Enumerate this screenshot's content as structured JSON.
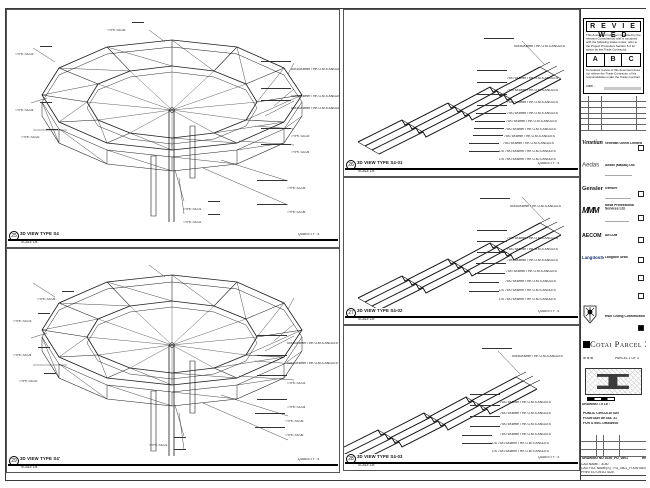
{
  "panels": [
    {
      "view_no": "25",
      "title": "3D VIEW TYPE S4",
      "scale": "SCALE 1/8",
      "quantity": "QUANTITY : 4",
      "callouts": [
        {
          "t": "TYPE S4-03",
          "x": 8,
          "y": 34,
          "a": "l"
        },
        {
          "t": "TYPE S4-05",
          "x": 100,
          "y": 10,
          "a": "l"
        },
        {
          "t": "TYPE S4-04",
          "x": 8,
          "y": 90,
          "a": "l"
        },
        {
          "t": "TYPE S4-02",
          "x": 14,
          "y": 117,
          "a": "l"
        },
        {
          "t": "50X50X6mm THK G.M.S ANGLES",
          "x": 284,
          "y": 49,
          "a": "r"
        },
        {
          "t": "50X50X6mm THK G.M.S ANGLES",
          "x": 284,
          "y": 76,
          "a": "r"
        },
        {
          "t": "50X50X6mm THK G.M.S ANGLES",
          "x": 284,
          "y": 88,
          "a": "r"
        },
        {
          "t": "TYPE S4-03",
          "x": 284,
          "y": 116,
          "a": "r"
        },
        {
          "t": "TYPE S4-04",
          "x": 284,
          "y": 132,
          "a": "r"
        },
        {
          "t": "TYPE S4-05",
          "x": 280,
          "y": 168,
          "a": "r"
        },
        {
          "t": "TYPE S4-06",
          "x": 280,
          "y": 192,
          "a": "r"
        },
        {
          "t": "TYPE S4-01",
          "x": 176,
          "y": 189,
          "a": "l"
        },
        {
          "t": "TYPE S4-02",
          "x": 176,
          "y": 202,
          "a": "l"
        }
      ]
    },
    {
      "view_no": "29",
      "title": "3D VIEW TYPE S4'",
      "scale": "SCALE 1/8",
      "quantity": "QUANTITY : 4",
      "callouts": [
        {
          "t": "TYPE S4-05",
          "x": 30,
          "y": 40,
          "a": "l"
        },
        {
          "t": "TYPE S4-03",
          "x": 6,
          "y": 62,
          "a": "l"
        },
        {
          "t": "TYPE S4-04",
          "x": 6,
          "y": 96,
          "a": "l"
        },
        {
          "t": "TYPE S4-02",
          "x": 12,
          "y": 122,
          "a": "l"
        },
        {
          "t": "50X50X6mm THK G.M.S ANGLES",
          "x": 280,
          "y": 84,
          "a": "r"
        },
        {
          "t": "50X50X6mm THK G.M.S ANGLES",
          "x": 280,
          "y": 104,
          "a": "r"
        },
        {
          "t": "TYPE S4-03",
          "x": 280,
          "y": 124,
          "a": "r"
        },
        {
          "t": "TYPE S4-04",
          "x": 280,
          "y": 148,
          "a": "r"
        },
        {
          "t": "TYPE S4-05",
          "x": 278,
          "y": 162,
          "a": "r"
        },
        {
          "t": "TYPE S4-06",
          "x": 278,
          "y": 176,
          "a": "r"
        },
        {
          "t": "TYPE S4-01",
          "x": 142,
          "y": 186,
          "a": "l"
        },
        {
          "t": "TYPE S4-02",
          "x": 142,
          "y": 198,
          "a": "l"
        }
      ]
    },
    {
      "view_no": "26",
      "title": "3D VIEW TYPE S4-01",
      "scale": "SCALE 1/8",
      "quantity": "QUANTITY : 4",
      "callouts": [
        {
          "t": "50X50X6mm THK G.M.S ANGLES",
          "x": 170,
          "y": 26,
          "a": "r"
        },
        {
          "t": "75X75X6mm THK G.M.S ANGLES",
          "x": 163,
          "y": 58,
          "a": "r"
        },
        {
          "t": "75X75X6mm THK G.M.S ANGLES",
          "x": 163,
          "y": 70,
          "a": "r"
        },
        {
          "t": "75X75X6mm THK G.M.S ANGLES",
          "x": 163,
          "y": 82,
          "a": "r"
        },
        {
          "t": "75X75X6mm THK G.M.S ANGLES",
          "x": 163,
          "y": 93,
          "a": "r"
        },
        {
          "t": "75X75X6mm THK G.M.S ANGLES",
          "x": 162,
          "y": 101,
          "a": "r"
        },
        {
          "t": "75X75X6mm THK G.M.S ANGLES",
          "x": 161,
          "y": 109,
          "a": "r"
        },
        {
          "t": "75X75X6mm THK G.M.S ANGLES",
          "x": 160,
          "y": 116,
          "a": "r"
        },
        {
          "t": "75X75X6mm THK G.M.S ANGLES",
          "x": 159,
          "y": 123,
          "a": "r"
        },
        {
          "t": "L/S 75X75X6mm THK G.M.S ANGLES",
          "x": 155,
          "y": 131,
          "a": "r"
        },
        {
          "t": "L/S 75X75X6mm THK G.M.S ANGLES",
          "x": 155,
          "y": 139,
          "a": "r"
        }
      ]
    },
    {
      "view_no": "27",
      "title": "3D VIEW TYPE S4-02",
      "scale": "SCALE 1/8",
      "quantity": "QUANTITY : 4",
      "callouts": [
        {
          "t": "50X50X6mm THK G.M.S ANGLES",
          "x": 166,
          "y": 18,
          "a": "r"
        },
        {
          "t": "75X75X6mm THK G.M.S ANGLES",
          "x": 163,
          "y": 50,
          "a": "r"
        },
        {
          "t": "75X75X6mm THK G.M.S ANGLES",
          "x": 163,
          "y": 61,
          "a": "r"
        },
        {
          "t": "75X75X6mm THK G.M.S ANGLES",
          "x": 163,
          "y": 72,
          "a": "r"
        },
        {
          "t": "75X75X6mm THK G.M.S ANGLES",
          "x": 162,
          "y": 83,
          "a": "r"
        },
        {
          "t": "75X75X6mm THK G.M.S ANGLES",
          "x": 161,
          "y": 93,
          "a": "r"
        },
        {
          "t": "L/S 75X75X6mm THK G.M.S ANGLES",
          "x": 155,
          "y": 102,
          "a": "r"
        },
        {
          "t": "L/S 75X75X6mm THK G.M.S ANGLES",
          "x": 155,
          "y": 111,
          "a": "r"
        }
      ]
    },
    {
      "view_no": "28",
      "title": "3D VIEW TYPE S4-03",
      "scale": "SCALE 1/8",
      "quantity": "QUANTITY : 4",
      "callouts": [
        {
          "t": "50X50X6mm THK G.M.S ANGLES",
          "x": 168,
          "y": 20,
          "a": "r"
        },
        {
          "t": "75X75X6mm THK G.M.S ANGLES",
          "x": 156,
          "y": 66,
          "a": "r"
        },
        {
          "t": "75X75X6mm THK G.M.S ANGLES",
          "x": 156,
          "y": 77,
          "a": "r"
        },
        {
          "t": "75X75X6mm THK G.M.S ANGLES",
          "x": 156,
          "y": 88,
          "a": "r"
        },
        {
          "t": "75X75X6mm THK G.M.S ANGLES",
          "x": 156,
          "y": 98,
          "a": "r"
        },
        {
          "t": "L/S 75X75X6mm THK G.M.S ANGLES",
          "x": 148,
          "y": 107,
          "a": "r"
        },
        {
          "t": "L/S 75X75X6mm THK G.M.S ANGLES",
          "x": 148,
          "y": 115,
          "a": "r"
        }
      ]
    }
  ],
  "titleblock": {
    "top_note": "DO NOT SCALE DRAWING. USE FIGURED DIMENSIONS ONLY.",
    "reviewed": {
      "title": "R E V I E W E D",
      "para1": "This document has been reviewed by the relevant Consultant(s) and is accepted with the following status noted, refer to the Project Procedure Section 5.4 for action by the Trade Contractor.",
      "options": [
        "A",
        "B",
        "C"
      ],
      "para2": "Consultant review of this document does not relieve the Trade Contractor of his responsibilities under the Trade Contract.",
      "date_label": "Date :"
    },
    "revision_header": [
      "NO.",
      "DATE",
      "DESCRIPTION",
      "BY"
    ],
    "consultants": [
      {
        "logo_text": "Venetian",
        "name": "Venetian Orient Limited"
      },
      {
        "logo_text": "Aedas",
        "name": "Aedas (Macau) Ltd."
      },
      {
        "logo_text": "Gensler",
        "name": "Gensler"
      },
      {
        "logo_text": "MMM",
        "name": "Meca Professional Services Ltd."
      },
      {
        "logo_text": "AECOM",
        "name": "AECOM"
      },
      {
        "logo_text": "LangdonSeah",
        "name": "Langdon Seah"
      }
    ],
    "contractor": {
      "name_line1": "Hsin Chong Construction",
      "name_line2": "(Macau) Co. Ltd."
    },
    "project_banner": "Cotai Parcel 3",
    "keyplan_note": "PARCEL 1 OF 3",
    "drawing": {
      "header": "DRAWING TITLE :",
      "title_lines": [
        "PUBLIC CIRCULATION",
        "FOUNTAIN DETAIL 31",
        "FOR STEEL DRAWING"
      ],
      "meta": [
        [
          "DESIGNED",
          "-",
          "DWG",
          "2342"
        ],
        [
          "DRAWN",
          "-",
          "DATE",
          "14/04/2010"
        ],
        [
          "APPROVED",
          "-",
          "SCALE",
          "AS SHOWN"
        ]
      ],
      "dwg_no_label": "DRAWING NO :",
      "dwg_no": "3150_PD_0501",
      "rev": "REV A",
      "cad_lines": [
        "CAD NAME : 3150",
        "CAD FILE NAME(S) : PD_0501_FOUNTAIN_31.DWG",
        "PRINTED ON A1 SIZE"
      ]
    }
  }
}
